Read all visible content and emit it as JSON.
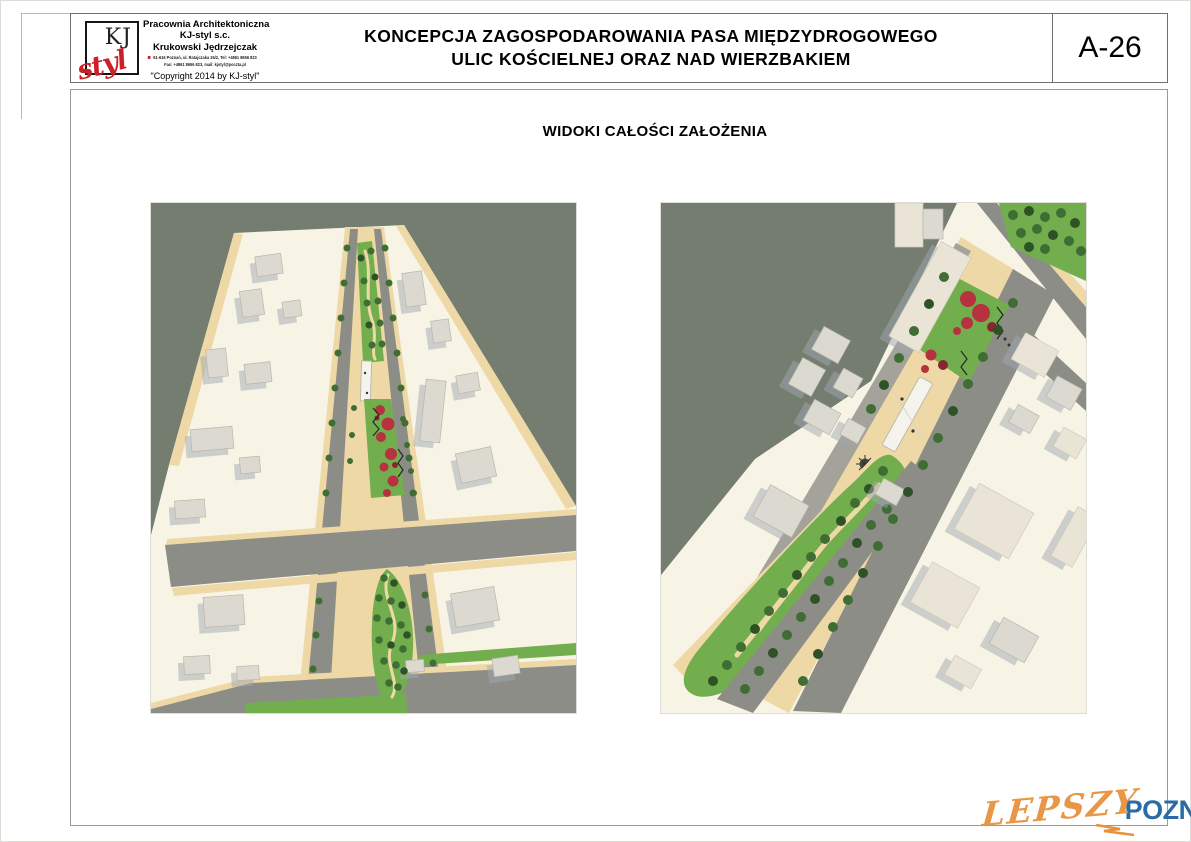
{
  "header": {
    "logo": {
      "top": "KJ",
      "script": "styl"
    },
    "firm": {
      "line1": "Pracownia Architektoniczna",
      "line2": "KJ-styl s.c.",
      "line3": "Krukowski Jędrzejczak",
      "address_line1": "61-616 Poznań, ul. Ratajczaka 26/2, Tel: +4861 8656 823",
      "address_line2": "Fax: +4861 8656 823, mail: kjstyl@poczta.pl",
      "copyright": "\"Copyright 2014 by KJ-styl\""
    },
    "title_line1": "KONCEPCJA ZAGOSPODAROWANIA PASA MIĘDZYDROGOWEGO",
    "title_line2": "ULIC KOŚCIELNEJ ORAZ NAD WIERZBAKIEM",
    "sheet_number": "A-26"
  },
  "content": {
    "subtitle": "WIDOKI CAŁOŚCI ZAŁOŻENIA"
  },
  "watermark": {
    "part1": "LEPSZY",
    "part2": "POZNAN",
    "part3": ".pl"
  },
  "colors": {
    "accent_red": "#cc2027",
    "wm_orange": "#e8913d",
    "wm_blue": "#2a6aa5",
    "backdrop": "#757c70",
    "terrain": "#f8f4e5",
    "sidewalk": "#eed9a6",
    "road": "#8d8d87",
    "road_light": "#a3a39b",
    "grass": "#72ae4d",
    "tree": "#3f6d33",
    "tree_dark": "#2e5226",
    "flower_red": "#b5323e",
    "flower_dark": "#8c2331",
    "building": "#dcd9d0",
    "building_side": "#b9b6ac",
    "building_warm": "#e9e4d6",
    "shadow_blue": "#9fa8b2",
    "white_roof": "#f4f3ec",
    "frame_gray": "#9a9a9a",
    "border_dark": "#6f6f6f"
  }
}
